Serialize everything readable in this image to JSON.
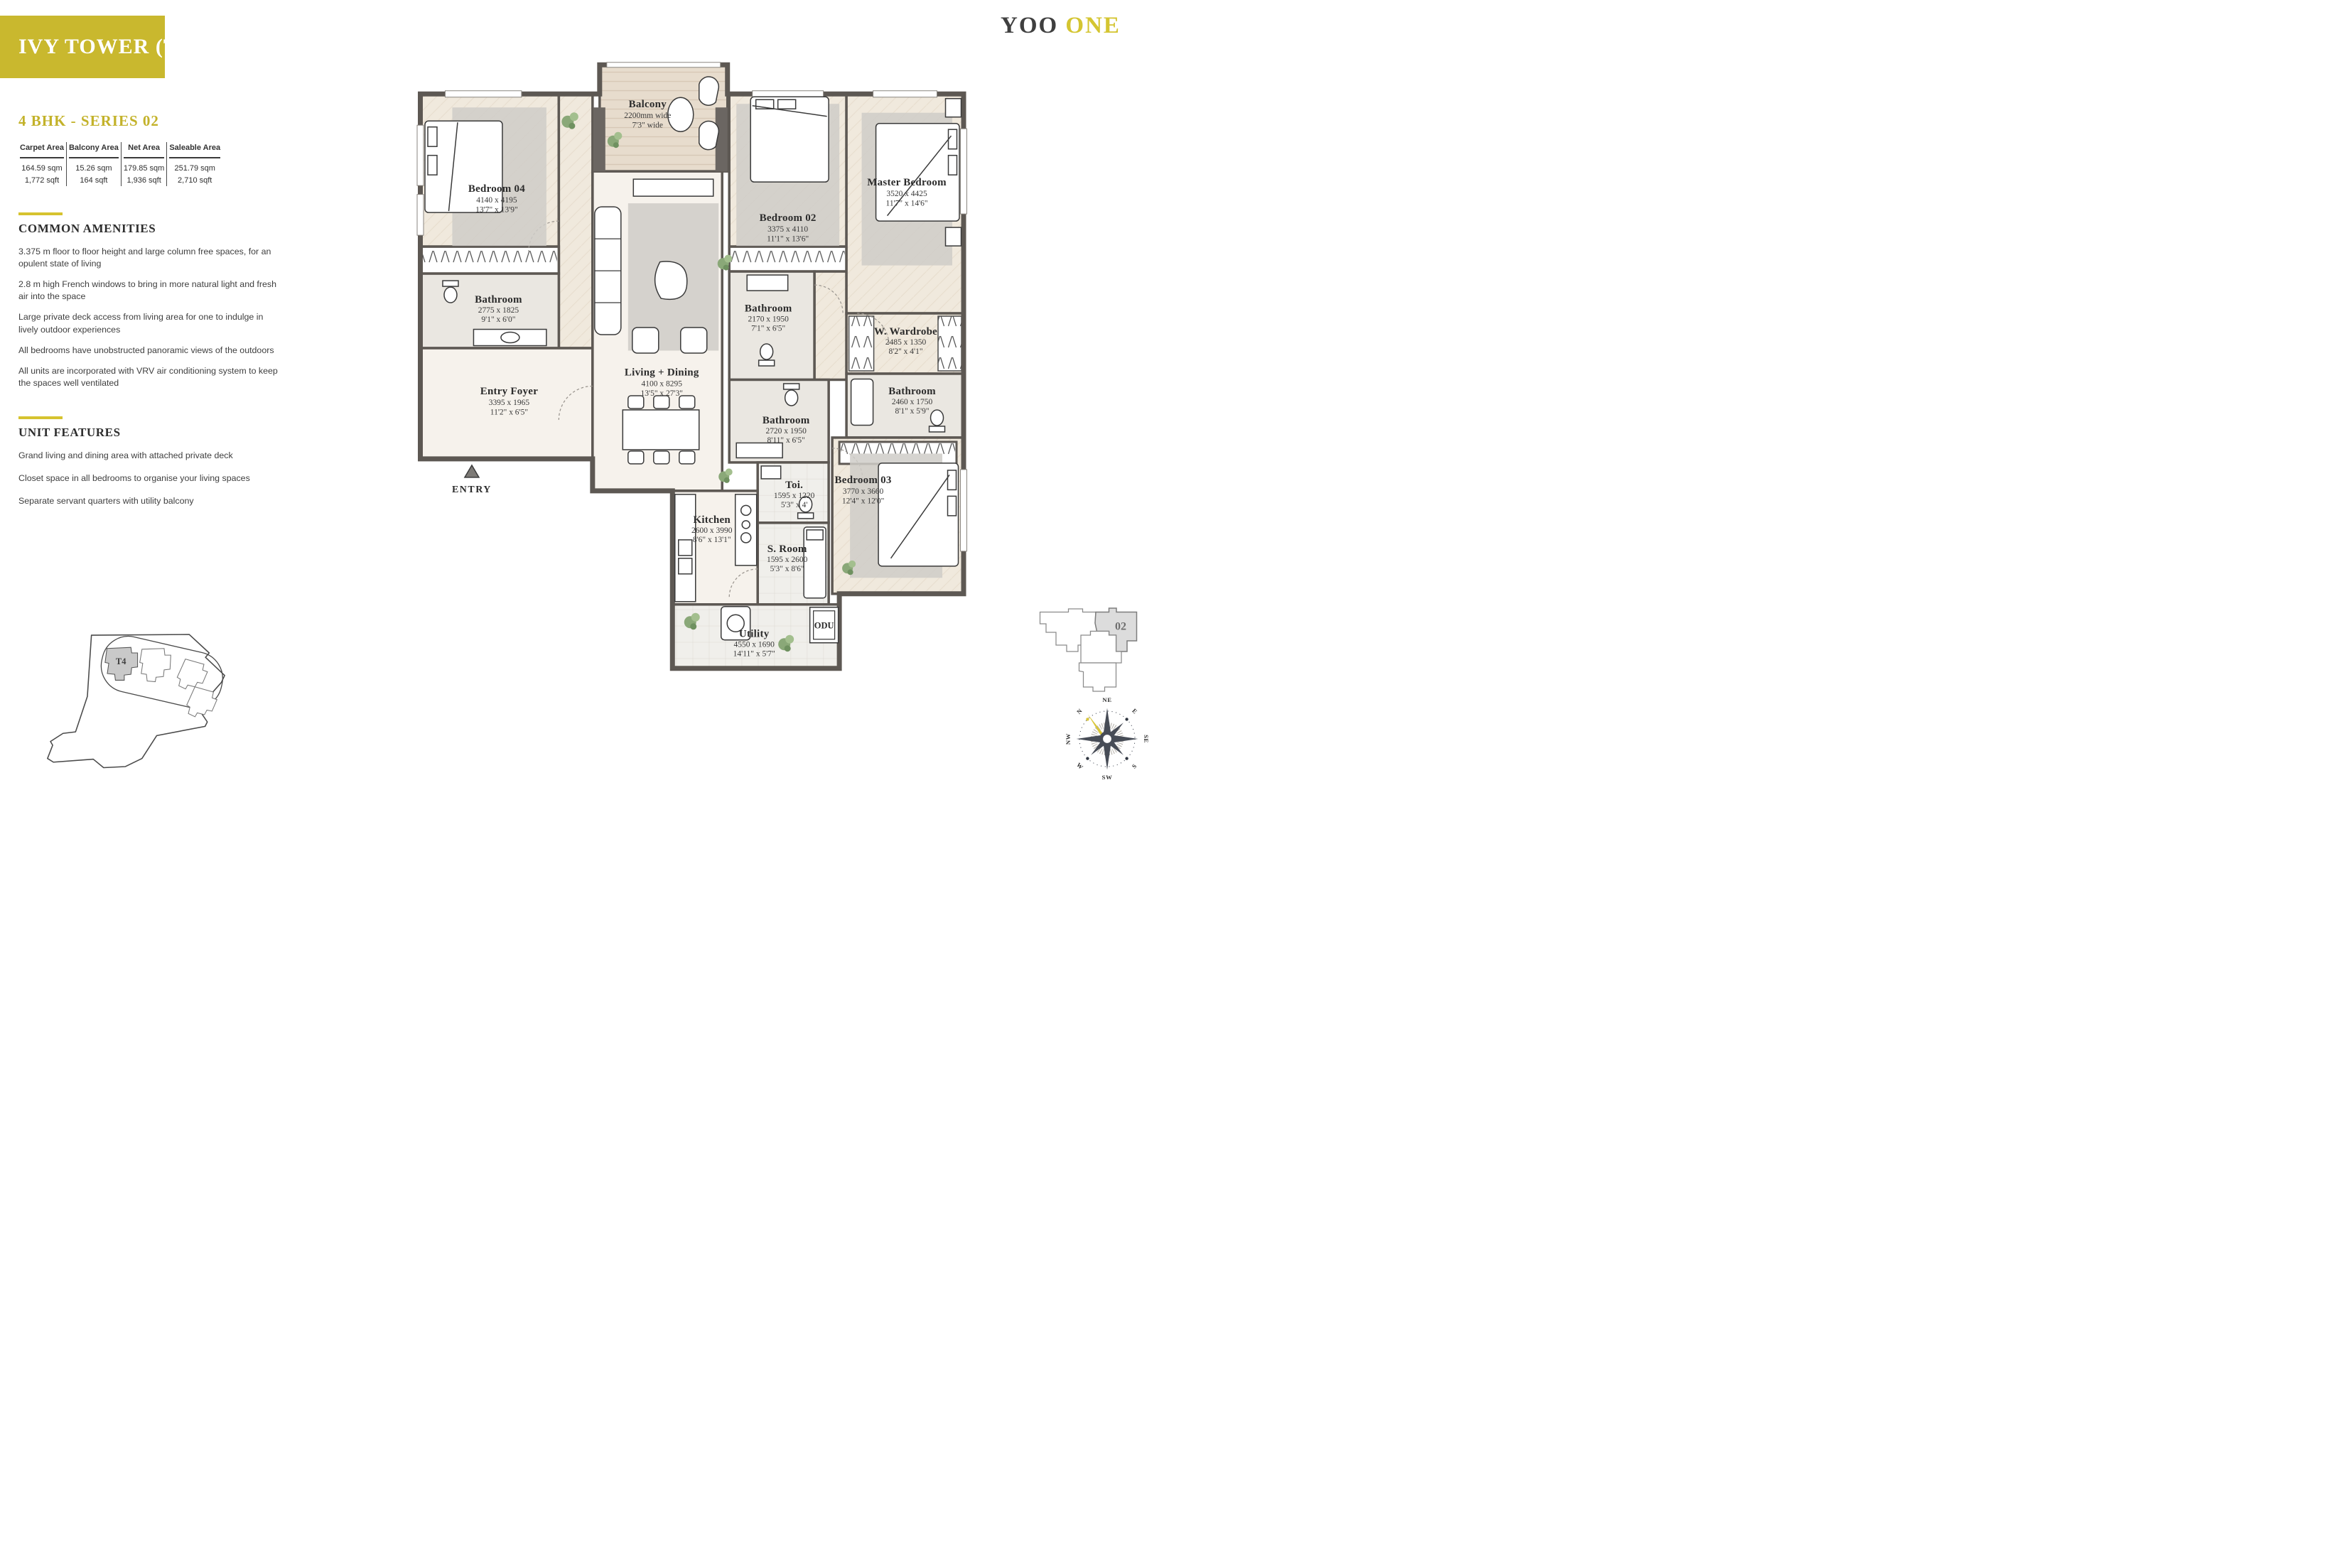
{
  "theme": {
    "accent_gold": "#C9B82E",
    "brand_dark": "#3F3F3F"
  },
  "header": {
    "tower_title": "IVY TOWER (T4)",
    "series_title": "4 BHK - SERIES 02",
    "brand_primary": "YOO",
    "brand_secondary": "ONE"
  },
  "area_table": {
    "columns": [
      "Carpet Area",
      "Balcony Area",
      "Net Area",
      "Saleable Area"
    ],
    "values": [
      {
        "sqm": "164.59 sqm",
        "sqft": "1,772 sqft"
      },
      {
        "sqm": "15.26 sqm",
        "sqft": "164 sqft"
      },
      {
        "sqm": "179.85 sqm",
        "sqft": "1,936 sqft"
      },
      {
        "sqm": "251.79 sqm",
        "sqft": "2,710 sqft"
      }
    ]
  },
  "common_amenities": {
    "heading": "COMMON AMENITIES",
    "items": [
      "3.375 m floor to floor height and large column free spaces, for an opulent state of living",
      "2.8 m high French windows to bring in more natural light and fresh air into the space",
      "Large private deck access from living area for one to indulge in lively outdoor experiences",
      "All bedrooms have unobstructed panoramic views of the outdoors",
      "All units are incorporated with VRV air conditioning system to keep the spaces well ventilated"
    ]
  },
  "unit_features": {
    "heading": "UNIT FEATURES",
    "items": [
      "Grand living and dining area with attached private deck",
      "Closet space in all bedrooms to organise your living spaces",
      "Separate servant quarters with utility balcony"
    ]
  },
  "floor_plan": {
    "entry_label": "ENTRY",
    "odu_label": "ODU",
    "rooms": [
      {
        "name": "Balcony",
        "dim_mm": "2200mm wide",
        "dim_ft": "7'3\" wide"
      },
      {
        "name": "Bedroom 04",
        "dim_mm": "4140 x 4195",
        "dim_ft": "13'7\" x 13'9\""
      },
      {
        "name": "Bedroom 02",
        "dim_mm": "3375 x 4110",
        "dim_ft": "11'1\" x 13'6\""
      },
      {
        "name": "Master Bedroom",
        "dim_mm": "3520 x 4425",
        "dim_ft": "11'7\" x 14'6\""
      },
      {
        "name": "Bathroom",
        "dim_mm": "2775 x 1825",
        "dim_ft": "9'1\" x 6'0\""
      },
      {
        "name": "Bathroom",
        "dim_mm": "2170 x 1950",
        "dim_ft": "7'1\" x 6'5\""
      },
      {
        "name": "W. Wardrobe",
        "dim_mm": "2485 x 1350",
        "dim_ft": "8'2\" x 4'1\""
      },
      {
        "name": "Bathroom",
        "dim_mm": "2460 x 1750",
        "dim_ft": "8'1\" x 5'9\""
      },
      {
        "name": "Entry Foyer",
        "dim_mm": "3395 x 1965",
        "dim_ft": "11'2\" x 6'5\""
      },
      {
        "name": "Living + Dining",
        "dim_mm": "4100 x 8295",
        "dim_ft": "13'5\" x 27'3\""
      },
      {
        "name": "Bathroom",
        "dim_mm": "2720 x 1950",
        "dim_ft": "8'11\" x 6'5\""
      },
      {
        "name": "Toi.",
        "dim_mm": "1595 x 1220",
        "dim_ft": "5'3\" x 4'"
      },
      {
        "name": "Bedroom 03",
        "dim_mm": "3770 x 3660",
        "dim_ft": "12'4\" x 12'0\""
      },
      {
        "name": "Kitchen",
        "dim_mm": "2600 x 3990",
        "dim_ft": "8'6\" x 13'1\""
      },
      {
        "name": "S. Room",
        "dim_mm": "1595 x 2600",
        "dim_ft": "5'3\" x 8'6\""
      },
      {
        "name": "Utility",
        "dim_mm": "4550 x 1690",
        "dim_ft": "14'11\" x 5'7\""
      }
    ]
  },
  "site_plan": {
    "tower_label": "T4"
  },
  "unit_key_plan": {
    "unit_label": "02"
  },
  "compass": {
    "directions": [
      "NE",
      "E",
      "SE",
      "S",
      "SW",
      "W",
      "NW",
      "N"
    ]
  }
}
